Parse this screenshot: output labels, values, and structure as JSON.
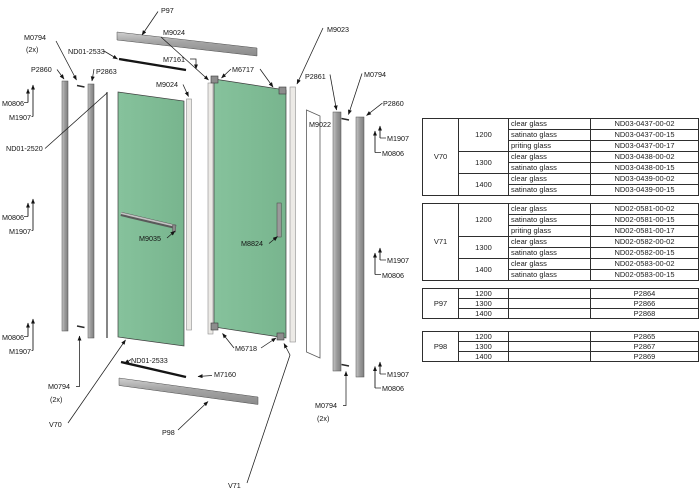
{
  "diagram": {
    "parts": {
      "p97": "P97",
      "p98": "P98",
      "v70": "V70",
      "v71": "V71",
      "m0794": "M0794",
      "qty_2x": "(2x)",
      "nd01_2533": "ND01-2533",
      "nd01_2520": "ND01-2520",
      "m7161": "M7161",
      "m7160": "M7160",
      "p2860": "P2860",
      "p2861": "P2861",
      "p2863": "P2863",
      "m0806": "M0806",
      "m1907": "M1907",
      "m9024": "M9024",
      "m9023": "M9023",
      "m9022": "M9022",
      "m6717": "M6717",
      "m6718": "M6718",
      "m9035": "M9035",
      "m8824": "M8824"
    },
    "colors": {
      "glass": "#7dbb94",
      "profile": "#a3a3a3",
      "line": "#1a1a1a"
    }
  },
  "tables": [
    {
      "name": "V70",
      "sections": [
        {
          "size": "1200",
          "entries": [
            {
              "type": "clear glass",
              "part": "ND03-0437-00-02"
            },
            {
              "type": "satinato glass",
              "part": "ND03-0437-00-15"
            },
            {
              "type": "priting glass",
              "part": "ND03-0437-00-17"
            }
          ]
        },
        {
          "size": "1300",
          "entries": [
            {
              "type": "clear glass",
              "part": "ND03-0438-00-02"
            },
            {
              "type": "satinato glass",
              "part": "ND03-0438-00-15"
            }
          ]
        },
        {
          "size": "1400",
          "entries": [
            {
              "type": "clear glass",
              "part": "ND03-0439-00-02"
            },
            {
              "type": "satinato glass",
              "part": "ND03-0439-00-15"
            }
          ]
        }
      ]
    },
    {
      "name": "V71",
      "sections": [
        {
          "size": "1200",
          "entries": [
            {
              "type": "clear glass",
              "part": "ND02-0581-00-02"
            },
            {
              "type": "satinato glass",
              "part": "ND02-0581-00-15"
            },
            {
              "type": "priting glass",
              "part": "ND02-0581-00-17"
            }
          ]
        },
        {
          "size": "1300",
          "entries": [
            {
              "type": "clear glass",
              "part": "ND02-0582-00-02"
            },
            {
              "type": "satinato glass",
              "part": "ND02-0582-00-15"
            }
          ]
        },
        {
          "size": "1400",
          "entries": [
            {
              "type": "clear glass",
              "part": "ND02-0583-00-02"
            },
            {
              "type": "satinato glass",
              "part": "ND02-0583-00-15"
            }
          ]
        }
      ]
    },
    {
      "name": "P97",
      "sections": [
        {
          "size": "1200",
          "entries": [
            {
              "type": "",
              "part": "P2864"
            }
          ]
        },
        {
          "size": "1300",
          "entries": [
            {
              "type": "",
              "part": "P2866"
            }
          ]
        },
        {
          "size": "1400",
          "entries": [
            {
              "type": "",
              "part": "P2868"
            }
          ]
        }
      ]
    },
    {
      "name": "P98",
      "sections": [
        {
          "size": "1200",
          "entries": [
            {
              "type": "",
              "part": "P2865"
            }
          ]
        },
        {
          "size": "1300",
          "entries": [
            {
              "type": "",
              "part": "P2867"
            }
          ]
        },
        {
          "size": "1400",
          "entries": [
            {
              "type": "",
              "part": "P2869"
            }
          ]
        }
      ]
    }
  ]
}
